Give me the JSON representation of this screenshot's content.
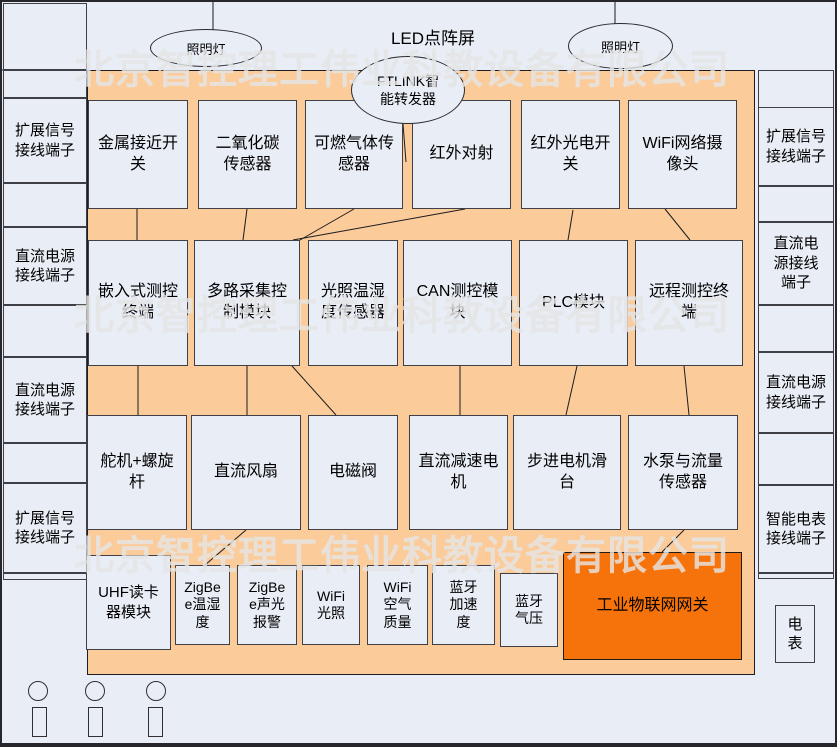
{
  "watermark": "北京智控理工伟业科教设备有限公司",
  "colors": {
    "panel_orange": "#FBCB99",
    "gateway_orange": "#F6730B",
    "box_fill": "#E9EDF6"
  },
  "top": {
    "led_label": "LED点阵屏",
    "lamp_left": "照明灯",
    "lamp_right": "照明灯",
    "ftlink": "FTLINK智\n能转发器"
  },
  "left_column": {
    "expand_signal_1": "扩展信号\n接线端子",
    "dc_power_1": "直流电源\n接线端子",
    "dc_power_2": "直流电源\n接线端子",
    "expand_signal_2": "扩展信号\n接线端子"
  },
  "right_column": {
    "expand_signal": "扩展信号\n接线端子",
    "dc_power_1": "直流电\n源接线\n端子",
    "dc_power_2": "直流电源\n接线端子",
    "smart_meter": "智能电表\n接线端子",
    "meter": "电\n表"
  },
  "row1": {
    "metal_proximity_switch": "金属接近开\n关",
    "co2_sensor": "二氧化碳\n传感器",
    "combustible_gas_sensor": "可燃气体传\n感器",
    "infrared_beam": "红外对射",
    "infrared_photo_switch": "红外光电开\n关",
    "wifi_camera": "WiFi网络摄\n像头"
  },
  "row2": {
    "embedded_terminal": "嵌入式测控\n终端",
    "multi_channel_module": "多路采集控\n制模块",
    "light_temp_humidity_sensor": "光照温湿\n度传感器",
    "can_module": "CAN测控模\n块",
    "plc_module": "PLC模块",
    "remote_terminal": "远程测控终\n端"
  },
  "row3": {
    "servo_screw": "舵机+螺旋\n杆",
    "dc_fan": "直流风扇",
    "solenoid_valve": "电磁阀",
    "dc_gear_motor": "直流减速电\n机",
    "stepper_slide": "步进电机滑\n台",
    "pump_flow_sensor": "水泵与流量\n传感器"
  },
  "row4": {
    "uhf_reader": "UHF读卡\n器模块",
    "zigbee_temp_humidity": "ZigBe\ne温湿\n度",
    "zigbee_sound_light_alarm": "ZigBe\ne声光\n报警",
    "wifi_light": "WiFi\n光照",
    "wifi_air_quality": "WiFi\n空气\n质量",
    "bluetooth_accel": "蓝牙\n加速\n度",
    "bluetooth_pressure": "蓝牙\n气压",
    "iot_gateway": "工业物联网网关"
  }
}
